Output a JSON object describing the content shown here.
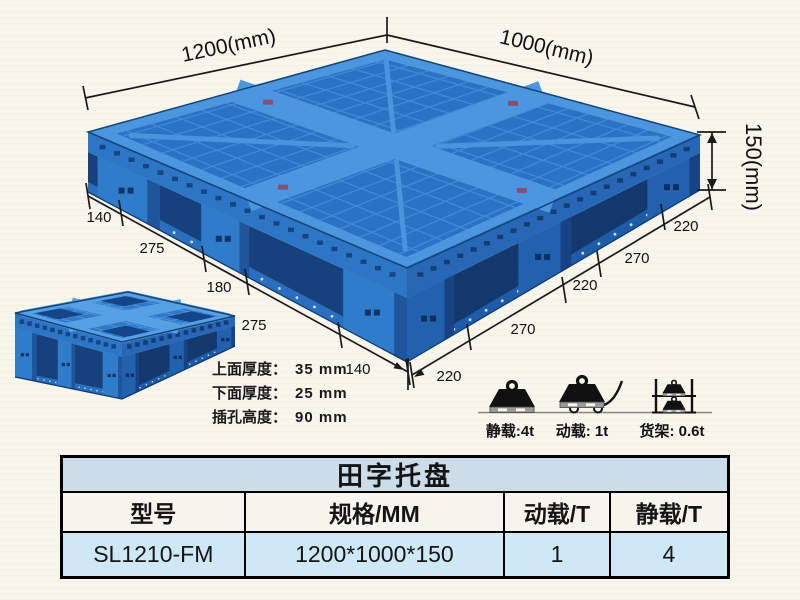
{
  "scene": {
    "dims": {
      "width_label": "1200(mm)",
      "depth_label": "1000(mm)",
      "height_label": "150(mm)",
      "left_chain": [
        "140",
        "275",
        "180",
        "275",
        "140"
      ],
      "right_chain": [
        "220",
        "270",
        "220",
        "270",
        "220"
      ]
    },
    "notes": [
      {
        "label": "上面厚度：",
        "value": "35 mm"
      },
      {
        "label": "下面厚度：",
        "value": "25 mm"
      },
      {
        "label": "插孔高度：",
        "value": "90 mm"
      }
    ],
    "loads": [
      {
        "name": "static-load",
        "label": "静载:4t"
      },
      {
        "name": "dynamic-load",
        "label": "动载: 1t"
      },
      {
        "name": "rack-load",
        "label": "货架: 0.6t"
      }
    ]
  },
  "table": {
    "title": "田字托盘",
    "headers": [
      "型号",
      "规格/MM",
      "动载/T",
      "静载/T"
    ],
    "row": [
      "SL1210-FM",
      "1200*1000*150",
      "1",
      "4"
    ]
  },
  "colors": {
    "pallet_blue": "#2e7ccc",
    "pallet_blue_dark": "#1c4f97",
    "table_title_bg": "#ccdce9",
    "table_data_bg": "#cfe8f5",
    "background": "#f8f6ec"
  }
}
